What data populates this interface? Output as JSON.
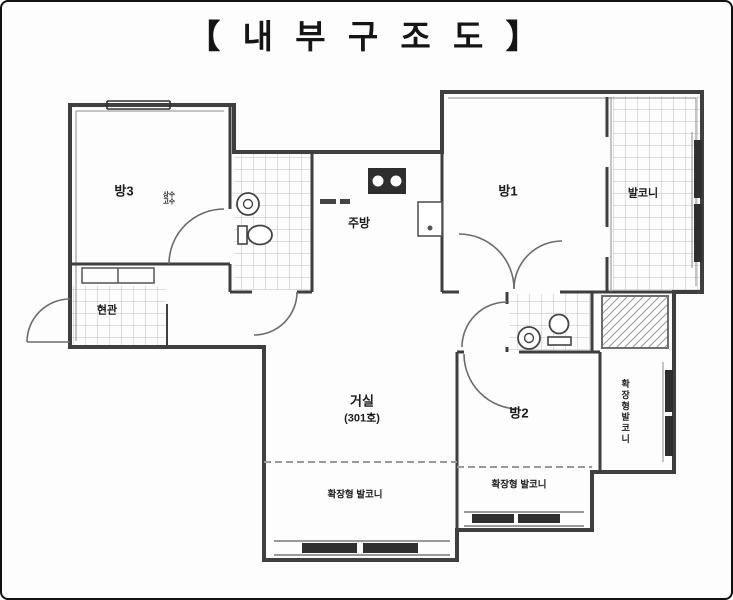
{
  "title": "【 내 부 구 조 도 】",
  "rooms": {
    "room3": "방3",
    "kitchen": "주방",
    "room1": "방1",
    "balcony": "발코니",
    "entrance": "현관",
    "living": "거실",
    "living_unit": "(301호)",
    "room2": "방2",
    "balcony_ext_left": "확장형 발코니",
    "balcony_ext_center": "확장형 발코니",
    "balcony_ext_right": "확장형발코니",
    "meter_note_line1": "상수",
    "meter_note_line2": "고수"
  },
  "colors": {
    "wall": "#3f3f3f",
    "tile_line": "#b9b9b9",
    "window_bar": "#2f2f2f",
    "text": "#1b1b1b"
  }
}
